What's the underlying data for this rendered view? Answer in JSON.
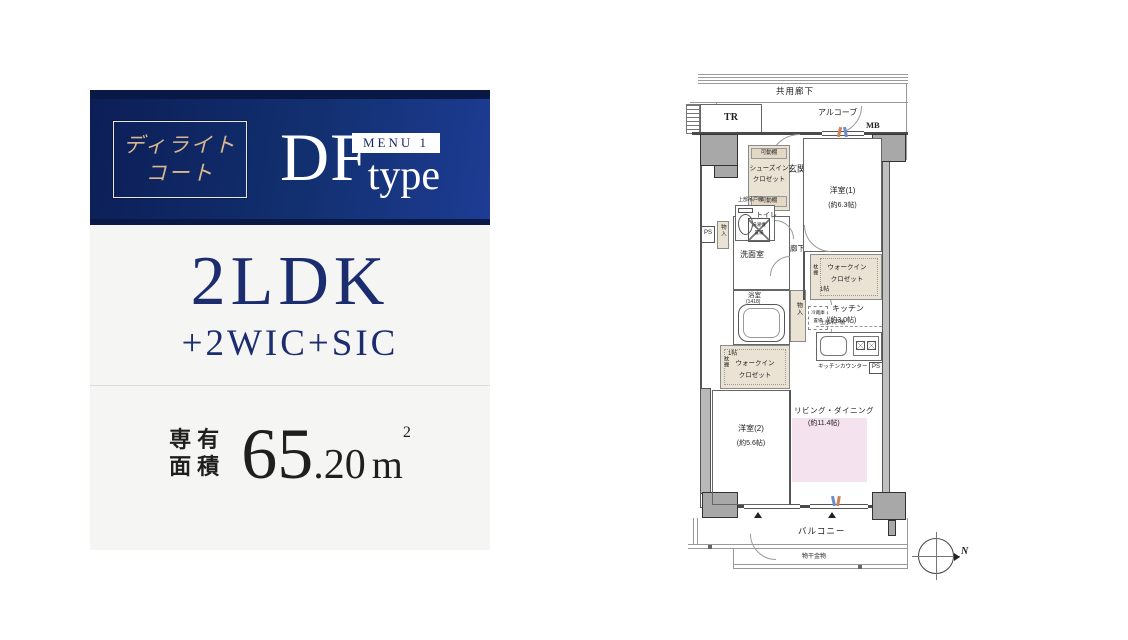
{
  "panel": {
    "brand_line1": "ディライト",
    "brand_line2": "コート",
    "type_code": "DF",
    "type_word": "type",
    "menu_badge": "MENU 1",
    "layout_main": "2LDK",
    "layout_sub": "+2WIC+SIC",
    "area_label_line1": "専有",
    "area_label_line2": "面積",
    "area_value_int": "65",
    "area_value_dec": ".20",
    "area_unit_base": "m",
    "area_unit_sup": "2",
    "area_full": "専有面積 65.20m2"
  },
  "floorplan": {
    "common_corridor": "共用廊下",
    "alcove": "アルコーブ",
    "trunk_room": "TR",
    "meter_box": "MB",
    "entrance": "玄関",
    "shoes_closet_line1": "シューズイン",
    "shoes_closet_line2": "クロゼット",
    "movable_shelf": "可動棚",
    "toilet": "トイレ",
    "upper_cabinet": "上部吊戸棚",
    "pipe_space": "PS",
    "storage": "物入",
    "washer_line1": "洗濯機",
    "washer_line2": "置場",
    "washroom": "洗面室",
    "hallway": "廊下",
    "bathroom": "浴室",
    "bathroom_size": "(1418)",
    "wic_line1": "ウォークイン",
    "wic_line2": "クロゼット",
    "wic_size": "1帖",
    "shelf": "枕棚",
    "bedroom1": "洋室(1)",
    "bedroom1_size": "(約6.3帖)",
    "fridge_line1": "冷蔵庫",
    "fridge_line2": "置場",
    "kitchen": "キッチン",
    "kitchen_size": "(約3.0帖)",
    "kitchen_counter": "キッチンカウンター",
    "living_dining": "リビング・ダイニング",
    "living_dining_size": "(約11.4帖)",
    "bedroom2": "洋室(2)",
    "bedroom2_size": "(約5.6帖)",
    "balcony": "バルコニー",
    "drying_fixture": "物干金物",
    "north": "N"
  },
  "colors": {
    "header_navy_dark": "#0a1845",
    "header_navy": "#123070",
    "header_navy_light": "#1e3c94",
    "brand_gold": "#d8b88c",
    "panel_bg": "#f5f5f4",
    "navy_text": "#1c2d6f",
    "closet_beige": "#eae2d3",
    "living_dining_pink": "#f4e3ee",
    "wall_gray": "#a8a8a8"
  }
}
